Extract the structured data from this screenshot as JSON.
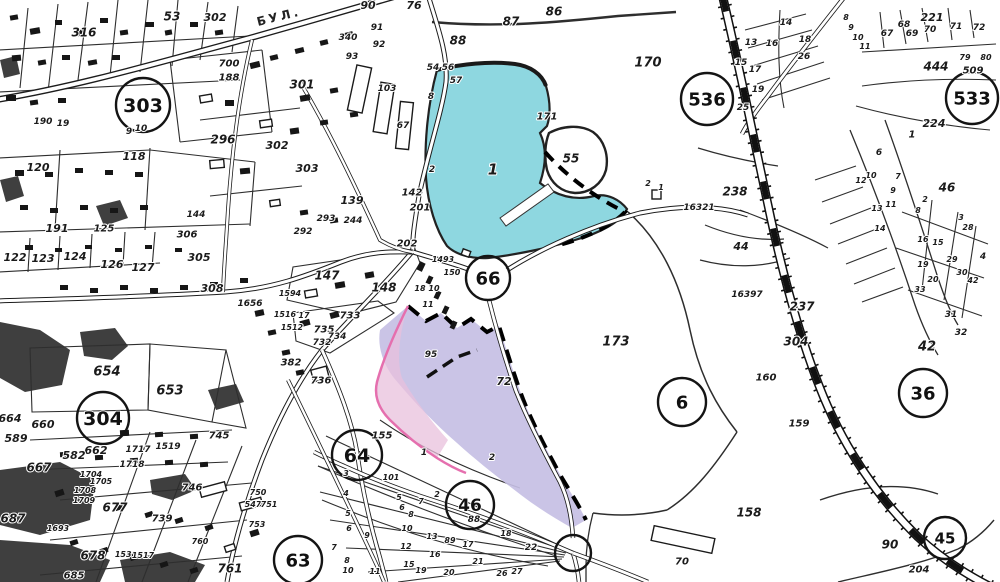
{
  "map": {
    "title": "cadastral-scan",
    "street_label": "БУЛ.",
    "colors": {
      "paper": "#ffffff",
      "ink": "#1b1b1b",
      "water": "#8ed7e0",
      "highlight": "#c6bfe4",
      "highlight_pink": "#e8c0dc",
      "pink_line": "#e56fae"
    },
    "zone_circles": [
      {
        "label": "303",
        "x": 143,
        "y": 105,
        "r": 27,
        "s": 19
      },
      {
        "label": "304",
        "x": 103,
        "y": 418,
        "r": 26,
        "s": 19
      },
      {
        "label": "536",
        "x": 707,
        "y": 99,
        "r": 26,
        "s": 18
      },
      {
        "label": "533",
        "x": 972,
        "y": 98,
        "r": 26,
        "s": 18
      },
      {
        "label": "66",
        "x": 488,
        "y": 278,
        "r": 22,
        "s": 18
      },
      {
        "label": "36",
        "x": 923,
        "y": 393,
        "r": 24,
        "s": 18
      },
      {
        "label": "6",
        "x": 682,
        "y": 402,
        "r": 24,
        "s": 18
      },
      {
        "label": "64",
        "x": 357,
        "y": 455,
        "r": 25,
        "s": 19
      },
      {
        "label": "46",
        "x": 470,
        "y": 505,
        "r": 24,
        "s": 17
      },
      {
        "label": "63",
        "x": 298,
        "y": 560,
        "r": 24,
        "s": 18
      },
      {
        "label": "45",
        "x": 945,
        "y": 538,
        "r": 21,
        "s": 15
      },
      {
        "label": "",
        "x": 573,
        "y": 553,
        "r": 18,
        "s": 0
      }
    ],
    "labels": [
      {
        "t": "53",
        "x": 172,
        "y": 16,
        "s": 12
      },
      {
        "t": "302",
        "x": 215,
        "y": 17,
        "s": 11
      },
      {
        "t": "316",
        "x": 84,
        "y": 32,
        "s": 12
      },
      {
        "t": "700",
        "x": 229,
        "y": 63,
        "s": 10
      },
      {
        "t": "188",
        "x": 229,
        "y": 77,
        "s": 10
      },
      {
        "t": "296",
        "x": 223,
        "y": 139,
        "s": 12
      },
      {
        "t": "9",
        "x": 129,
        "y": 131,
        "s": 9
      },
      {
        "t": "10",
        "x": 141,
        "y": 128,
        "s": 9
      },
      {
        "t": "118",
        "x": 134,
        "y": 156,
        "s": 11
      },
      {
        "t": "190",
        "x": 43,
        "y": 121,
        "s": 9
      },
      {
        "t": "19",
        "x": 63,
        "y": 123,
        "s": 9
      },
      {
        "t": "120",
        "x": 38,
        "y": 167,
        "s": 11
      },
      {
        "t": "191",
        "x": 57,
        "y": 228,
        "s": 11
      },
      {
        "t": "125",
        "x": 104,
        "y": 228,
        "s": 10
      },
      {
        "t": "144",
        "x": 196,
        "y": 214,
        "s": 9
      },
      {
        "t": "122",
        "x": 15,
        "y": 257,
        "s": 11
      },
      {
        "t": "123",
        "x": 43,
        "y": 258,
        "s": 11
      },
      {
        "t": "124",
        "x": 75,
        "y": 256,
        "s": 11
      },
      {
        "t": "126",
        "x": 112,
        "y": 264,
        "s": 11
      },
      {
        "t": "127",
        "x": 143,
        "y": 267,
        "s": 11
      },
      {
        "t": "306",
        "x": 187,
        "y": 234,
        "s": 10
      },
      {
        "t": "305",
        "x": 199,
        "y": 257,
        "s": 11
      },
      {
        "t": "1656",
        "x": 250,
        "y": 303,
        "s": 9
      },
      {
        "t": "308",
        "x": 212,
        "y": 288,
        "s": 11
      },
      {
        "t": "90",
        "x": 368,
        "y": 5,
        "s": 11
      },
      {
        "t": "76",
        "x": 414,
        "y": 5,
        "s": 11
      },
      {
        "t": "91",
        "x": 377,
        "y": 27,
        "s": 9
      },
      {
        "t": "92",
        "x": 379,
        "y": 44,
        "s": 9
      },
      {
        "t": "93",
        "x": 352,
        "y": 56,
        "s": 9
      },
      {
        "t": "340",
        "x": 348,
        "y": 37,
        "s": 9
      },
      {
        "t": "88",
        "x": 458,
        "y": 40,
        "s": 12
      },
      {
        "t": "87",
        "x": 511,
        "y": 21,
        "s": 12
      },
      {
        "t": "86",
        "x": 554,
        "y": 11,
        "s": 12
      },
      {
        "t": "301",
        "x": 302,
        "y": 84,
        "s": 12
      },
      {
        "t": "302",
        "x": 277,
        "y": 145,
        "s": 11
      },
      {
        "t": "303",
        "x": 307,
        "y": 168,
        "s": 11
      },
      {
        "t": "103",
        "x": 387,
        "y": 88,
        "s": 9
      },
      {
        "t": "67",
        "x": 403,
        "y": 125,
        "s": 9
      },
      {
        "t": "54",
        "x": 433,
        "y": 67,
        "s": 9
      },
      {
        "t": "56",
        "x": 448,
        "y": 67,
        "s": 9
      },
      {
        "t": "57",
        "x": 456,
        "y": 80,
        "s": 9
      },
      {
        "t": "8",
        "x": 431,
        "y": 96,
        "s": 9
      },
      {
        "t": "139",
        "x": 352,
        "y": 200,
        "s": 11
      },
      {
        "t": "293",
        "x": 326,
        "y": 218,
        "s": 9
      },
      {
        "t": "244",
        "x": 353,
        "y": 220,
        "s": 9
      },
      {
        "t": "292",
        "x": 303,
        "y": 231,
        "s": 9
      },
      {
        "t": "142",
        "x": 412,
        "y": 192,
        "s": 10
      },
      {
        "t": "201",
        "x": 420,
        "y": 207,
        "s": 10
      },
      {
        "t": "202",
        "x": 407,
        "y": 243,
        "s": 10
      },
      {
        "t": "2",
        "x": 432,
        "y": 169,
        "s": 9
      },
      {
        "t": "147",
        "x": 327,
        "y": 275,
        "s": 12
      },
      {
        "t": "148",
        "x": 384,
        "y": 287,
        "s": 12
      },
      {
        "t": "1594",
        "x": 290,
        "y": 293,
        "s": 8
      },
      {
        "t": "1516",
        "x": 285,
        "y": 314,
        "s": 8
      },
      {
        "t": "17",
        "x": 304,
        "y": 315,
        "s": 8
      },
      {
        "t": "733",
        "x": 350,
        "y": 315,
        "s": 10
      },
      {
        "t": "735",
        "x": 324,
        "y": 329,
        "s": 10
      },
      {
        "t": "734",
        "x": 337,
        "y": 336,
        "s": 9
      },
      {
        "t": "732",
        "x": 322,
        "y": 342,
        "s": 9
      },
      {
        "t": "1512",
        "x": 292,
        "y": 327,
        "s": 8
      },
      {
        "t": "382",
        "x": 291,
        "y": 362,
        "s": 10
      },
      {
        "t": "736",
        "x": 321,
        "y": 380,
        "s": 10
      },
      {
        "t": "1493",
        "x": 443,
        "y": 259,
        "s": 8
      },
      {
        "t": "150",
        "x": 452,
        "y": 272,
        "s": 8
      },
      {
        "t": "18",
        "x": 420,
        "y": 288,
        "s": 8
      },
      {
        "t": "10",
        "x": 434,
        "y": 288,
        "s": 8
      },
      {
        "t": "11",
        "x": 428,
        "y": 304,
        "s": 8
      },
      {
        "t": "95",
        "x": 431,
        "y": 354,
        "s": 9
      },
      {
        "t": "72",
        "x": 504,
        "y": 381,
        "s": 11
      },
      {
        "t": "155",
        "x": 382,
        "y": 435,
        "s": 10
      },
      {
        "t": "1",
        "x": 493,
        "y": 169,
        "s": 15
      },
      {
        "t": "55",
        "x": 571,
        "y": 158,
        "s": 12
      },
      {
        "t": "171",
        "x": 547,
        "y": 116,
        "s": 10
      },
      {
        "t": "170",
        "x": 648,
        "y": 62,
        "s": 13
      },
      {
        "t": "2",
        "x": 648,
        "y": 183,
        "s": 8
      },
      {
        "t": "1",
        "x": 661,
        "y": 187,
        "s": 8
      },
      {
        "t": "221",
        "x": 932,
        "y": 17,
        "s": 11
      },
      {
        "t": "68",
        "x": 904,
        "y": 24,
        "s": 9
      },
      {
        "t": "69",
        "x": 912,
        "y": 33,
        "s": 9
      },
      {
        "t": "70",
        "x": 930,
        "y": 29,
        "s": 9
      },
      {
        "t": "71",
        "x": 956,
        "y": 26,
        "s": 9
      },
      {
        "t": "72",
        "x": 979,
        "y": 27,
        "s": 9
      },
      {
        "t": "67",
        "x": 887,
        "y": 33,
        "s": 9
      },
      {
        "t": "444",
        "x": 936,
        "y": 66,
        "s": 12
      },
      {
        "t": "509",
        "x": 973,
        "y": 70,
        "s": 10
      },
      {
        "t": "79",
        "x": 965,
        "y": 57,
        "s": 8
      },
      {
        "t": "80",
        "x": 986,
        "y": 57,
        "s": 8
      },
      {
        "t": "224",
        "x": 934,
        "y": 123,
        "s": 11
      },
      {
        "t": "1",
        "x": 912,
        "y": 134,
        "s": 10
      },
      {
        "t": "8",
        "x": 846,
        "y": 17,
        "s": 8
      },
      {
        "t": "9",
        "x": 851,
        "y": 27,
        "s": 8
      },
      {
        "t": "10",
        "x": 858,
        "y": 37,
        "s": 8
      },
      {
        "t": "11",
        "x": 865,
        "y": 46,
        "s": 8
      },
      {
        "t": "14",
        "x": 786,
        "y": 22,
        "s": 9
      },
      {
        "t": "18",
        "x": 805,
        "y": 39,
        "s": 9
      },
      {
        "t": "16",
        "x": 772,
        "y": 43,
        "s": 9
      },
      {
        "t": "13",
        "x": 751,
        "y": 42,
        "s": 9
      },
      {
        "t": "26",
        "x": 804,
        "y": 56,
        "s": 9
      },
      {
        "t": "15",
        "x": 741,
        "y": 62,
        "s": 9
      },
      {
        "t": "17",
        "x": 755,
        "y": 69,
        "s": 9
      },
      {
        "t": "19",
        "x": 758,
        "y": 89,
        "s": 9
      },
      {
        "t": "25",
        "x": 743,
        "y": 107,
        "s": 9
      },
      {
        "t": "46",
        "x": 947,
        "y": 187,
        "s": 12
      },
      {
        "t": "6",
        "x": 879,
        "y": 152,
        "s": 9
      },
      {
        "t": "10",
        "x": 871,
        "y": 175,
        "s": 8
      },
      {
        "t": "12",
        "x": 861,
        "y": 180,
        "s": 8
      },
      {
        "t": "7",
        "x": 898,
        "y": 176,
        "s": 8
      },
      {
        "t": "9",
        "x": 893,
        "y": 190,
        "s": 8
      },
      {
        "t": "11",
        "x": 891,
        "y": 204,
        "s": 8
      },
      {
        "t": "13",
        "x": 877,
        "y": 208,
        "s": 8
      },
      {
        "t": "8",
        "x": 918,
        "y": 210,
        "s": 8
      },
      {
        "t": "2",
        "x": 925,
        "y": 199,
        "s": 8
      },
      {
        "t": "3",
        "x": 961,
        "y": 217,
        "s": 8
      },
      {
        "t": "28",
        "x": 968,
        "y": 227,
        "s": 8
      },
      {
        "t": "14",
        "x": 880,
        "y": 228,
        "s": 8
      },
      {
        "t": "16",
        "x": 923,
        "y": 239,
        "s": 8
      },
      {
        "t": "15",
        "x": 938,
        "y": 242,
        "s": 8
      },
      {
        "t": "29",
        "x": 952,
        "y": 259,
        "s": 8
      },
      {
        "t": "4",
        "x": 983,
        "y": 256,
        "s": 9
      },
      {
        "t": "30",
        "x": 962,
        "y": 272,
        "s": 8
      },
      {
        "t": "42",
        "x": 973,
        "y": 280,
        "s": 8
      },
      {
        "t": "20",
        "x": 933,
        "y": 279,
        "s": 8
      },
      {
        "t": "33",
        "x": 920,
        "y": 289,
        "s": 8
      },
      {
        "t": "19",
        "x": 923,
        "y": 264,
        "s": 8
      },
      {
        "t": "31",
        "x": 951,
        "y": 314,
        "s": 9
      },
      {
        "t": "32",
        "x": 961,
        "y": 332,
        "s": 9
      },
      {
        "t": "42",
        "x": 927,
        "y": 346,
        "s": 13
      },
      {
        "t": "16321",
        "x": 699,
        "y": 207,
        "s": 9
      },
      {
        "t": "16397",
        "x": 747,
        "y": 294,
        "s": 9
      },
      {
        "t": "238",
        "x": 735,
        "y": 191,
        "s": 12
      },
      {
        "t": "44",
        "x": 741,
        "y": 246,
        "s": 11
      },
      {
        "t": "237",
        "x": 802,
        "y": 306,
        "s": 12
      },
      {
        "t": "304",
        "x": 796,
        "y": 341,
        "s": 12
      },
      {
        "t": "173",
        "x": 616,
        "y": 341,
        "s": 13
      },
      {
        "t": "160",
        "x": 766,
        "y": 377,
        "s": 10
      },
      {
        "t": "159",
        "x": 799,
        "y": 423,
        "s": 10
      },
      {
        "t": "158",
        "x": 749,
        "y": 512,
        "s": 12
      },
      {
        "t": "70",
        "x": 682,
        "y": 561,
        "s": 10
      },
      {
        "t": "90",
        "x": 890,
        "y": 544,
        "s": 12
      },
      {
        "t": "204",
        "x": 919,
        "y": 569,
        "s": 10
      },
      {
        "t": "654",
        "x": 107,
        "y": 371,
        "s": 13
      },
      {
        "t": "653",
        "x": 170,
        "y": 390,
        "s": 13
      },
      {
        "t": "664",
        "x": 10,
        "y": 418,
        "s": 11
      },
      {
        "t": "660",
        "x": 43,
        "y": 424,
        "s": 11
      },
      {
        "t": "589",
        "x": 16,
        "y": 438,
        "s": 11
      },
      {
        "t": "662",
        "x": 96,
        "y": 450,
        "s": 11
      },
      {
        "t": "582",
        "x": 74,
        "y": 455,
        "s": 11
      },
      {
        "t": "667",
        "x": 39,
        "y": 467,
        "s": 12
      },
      {
        "t": "1717",
        "x": 138,
        "y": 449,
        "s": 9
      },
      {
        "t": "1718",
        "x": 132,
        "y": 464,
        "s": 9
      },
      {
        "t": "1519",
        "x": 168,
        "y": 446,
        "s": 9
      },
      {
        "t": "745",
        "x": 219,
        "y": 435,
        "s": 10
      },
      {
        "t": "1704",
        "x": 91,
        "y": 474,
        "s": 8
      },
      {
        "t": "1705",
        "x": 101,
        "y": 481,
        "s": 8
      },
      {
        "t": "1708",
        "x": 85,
        "y": 490,
        "s": 8
      },
      {
        "t": "1709",
        "x": 84,
        "y": 500,
        "s": 8
      },
      {
        "t": "677",
        "x": 115,
        "y": 507,
        "s": 12
      },
      {
        "t": "678",
        "x": 93,
        "y": 555,
        "s": 12
      },
      {
        "t": "687",
        "x": 13,
        "y": 518,
        "s": 12
      },
      {
        "t": "739",
        "x": 162,
        "y": 518,
        "s": 10
      },
      {
        "t": "746",
        "x": 192,
        "y": 487,
        "s": 10
      },
      {
        "t": "761",
        "x": 230,
        "y": 568,
        "s": 12
      },
      {
        "t": "1693",
        "x": 58,
        "y": 528,
        "s": 8
      },
      {
        "t": "685",
        "x": 74,
        "y": 575,
        "s": 10
      },
      {
        "t": "1530",
        "x": 126,
        "y": 554,
        "s": 8
      },
      {
        "t": "1517",
        "x": 143,
        "y": 555,
        "s": 8
      },
      {
        "t": "750",
        "x": 258,
        "y": 492,
        "s": 8
      },
      {
        "t": "547",
        "x": 253,
        "y": 504,
        "s": 8
      },
      {
        "t": "751",
        "x": 269,
        "y": 504,
        "s": 8
      },
      {
        "t": "753",
        "x": 257,
        "y": 524,
        "s": 8
      },
      {
        "t": "760",
        "x": 200,
        "y": 541,
        "s": 8
      },
      {
        "t": "1",
        "x": 424,
        "y": 452,
        "s": 9
      },
      {
        "t": "2",
        "x": 492,
        "y": 457,
        "s": 9
      },
      {
        "t": "101",
        "x": 391,
        "y": 477,
        "s": 8
      },
      {
        "t": "3",
        "x": 346,
        "y": 473,
        "s": 8
      },
      {
        "t": "4",
        "x": 346,
        "y": 493,
        "s": 8
      },
      {
        "t": "5",
        "x": 348,
        "y": 513,
        "s": 8
      },
      {
        "t": "6",
        "x": 349,
        "y": 528,
        "s": 8
      },
      {
        "t": "7",
        "x": 334,
        "y": 547,
        "s": 8
      },
      {
        "t": "8",
        "x": 347,
        "y": 560,
        "s": 8
      },
      {
        "t": "9",
        "x": 367,
        "y": 535,
        "s": 8
      },
      {
        "t": "10",
        "x": 348,
        "y": 570,
        "s": 8
      },
      {
        "t": "11",
        "x": 375,
        "y": 571,
        "s": 8
      },
      {
        "t": "5",
        "x": 399,
        "y": 497,
        "s": 8
      },
      {
        "t": "6",
        "x": 402,
        "y": 507,
        "s": 8
      },
      {
        "t": "7",
        "x": 421,
        "y": 501,
        "s": 8
      },
      {
        "t": "8",
        "x": 411,
        "y": 514,
        "s": 8
      },
      {
        "t": "10",
        "x": 407,
        "y": 528,
        "s": 8
      },
      {
        "t": "12",
        "x": 406,
        "y": 546,
        "s": 8
      },
      {
        "t": "13",
        "x": 432,
        "y": 536,
        "s": 8
      },
      {
        "t": "15",
        "x": 409,
        "y": 564,
        "s": 8
      },
      {
        "t": "16",
        "x": 435,
        "y": 554,
        "s": 8
      },
      {
        "t": "19",
        "x": 421,
        "y": 570,
        "s": 8
      },
      {
        "t": "20",
        "x": 449,
        "y": 572,
        "s": 8
      },
      {
        "t": "21",
        "x": 478,
        "y": 561,
        "s": 8
      },
      {
        "t": "22",
        "x": 531,
        "y": 547,
        "s": 9
      },
      {
        "t": "26",
        "x": 502,
        "y": 573,
        "s": 8
      },
      {
        "t": "27",
        "x": 517,
        "y": 571,
        "s": 8
      },
      {
        "t": "88",
        "x": 474,
        "y": 519,
        "s": 9
      },
      {
        "t": "89",
        "x": 450,
        "y": 540,
        "s": 8
      },
      {
        "t": "17",
        "x": 468,
        "y": 544,
        "s": 8
      },
      {
        "t": "18",
        "x": 506,
        "y": 533,
        "s": 8
      },
      {
        "t": "2",
        "x": 437,
        "y": 494,
        "s": 8
      }
    ]
  }
}
